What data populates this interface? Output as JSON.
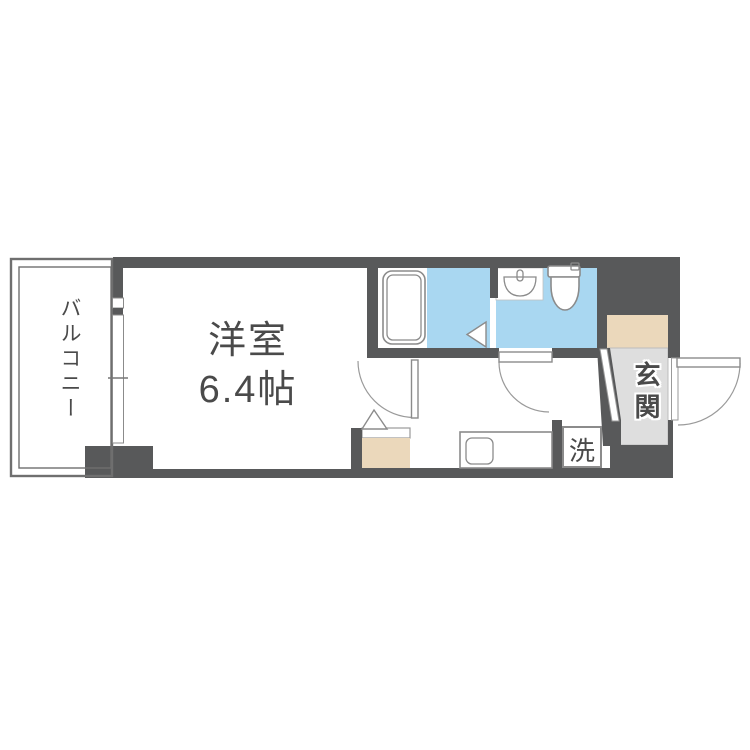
{
  "labels": {
    "balcony": "バルコニー",
    "room_name": "洋室",
    "room_size": "6.4帖",
    "entrance": "玄関",
    "laundry": "洗"
  },
  "areas": [
    {
      "name": "balcony",
      "label": "バルコニー"
    },
    {
      "name": "western-room",
      "label": "洋室",
      "size": "6.4帖"
    },
    {
      "name": "bathroom",
      "fixtures": [
        "bathtub-icon",
        "folding-door-icon"
      ]
    },
    {
      "name": "toilet-room",
      "fixtures": [
        "washbasin-icon",
        "toilet-icon"
      ]
    },
    {
      "name": "hallway",
      "fixtures": [
        "kitchen-sink-icon",
        "room-door-swing",
        "toilet-door-swing"
      ]
    },
    {
      "name": "laundry-space",
      "label": "洗"
    },
    {
      "name": "entrance",
      "label": "玄関",
      "fixtures": [
        "shoe-cabinet",
        "entrance-door-swing"
      ]
    }
  ],
  "colors": {
    "wall": "#58595a",
    "water": "#a9d7f1",
    "beige": "#ebd8bb",
    "entrance_floor": "#dedede",
    "outline": "#8b8b8b",
    "door_line": "#9a9a9a",
    "balcony_border": "#6f6f6f",
    "text": "#4a4a4a"
  }
}
